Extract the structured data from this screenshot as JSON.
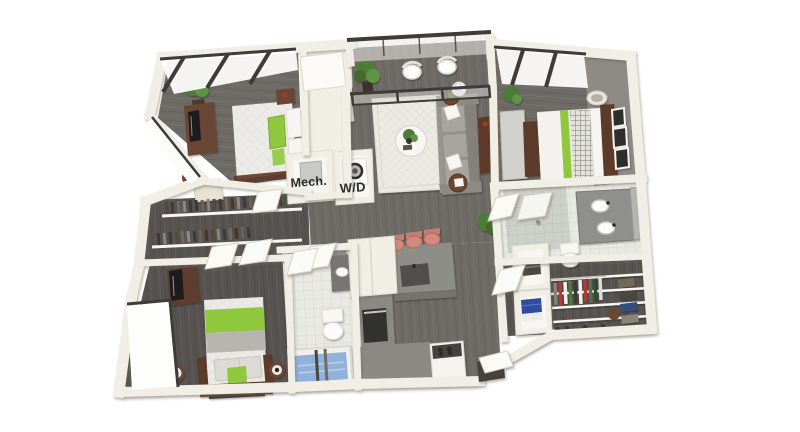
{
  "labels": {
    "mech_room": "Mech.",
    "washer_dryer": "W/D"
  },
  "colors": {
    "background": "#ffffff",
    "wall": "#f1eee6",
    "wallShade": "#dbd5c8",
    "floorWood": "#6e6a65",
    "floorWoodDark": "#565350",
    "accentWallGray": "#8e8b87",
    "accentGreen": "#90c83d",
    "tileLight": "#e9e9e4",
    "tileShower": "#cdd0c8",
    "tubBlue": "#8fb1da",
    "stoolSalmon": "#d08a7e",
    "sofaGray": "#a7a49e",
    "rugCream": "#eceae3",
    "furnitureBrown": "#6b4634",
    "furnitureBrownDark": "#5d3a2a",
    "frameDark": "#3e3c38",
    "counterGray": "#8e8e89",
    "towelBlue": "#2e4da0",
    "plantGreen": "#4e7c38",
    "ink": "#2b2b2b"
  }
}
